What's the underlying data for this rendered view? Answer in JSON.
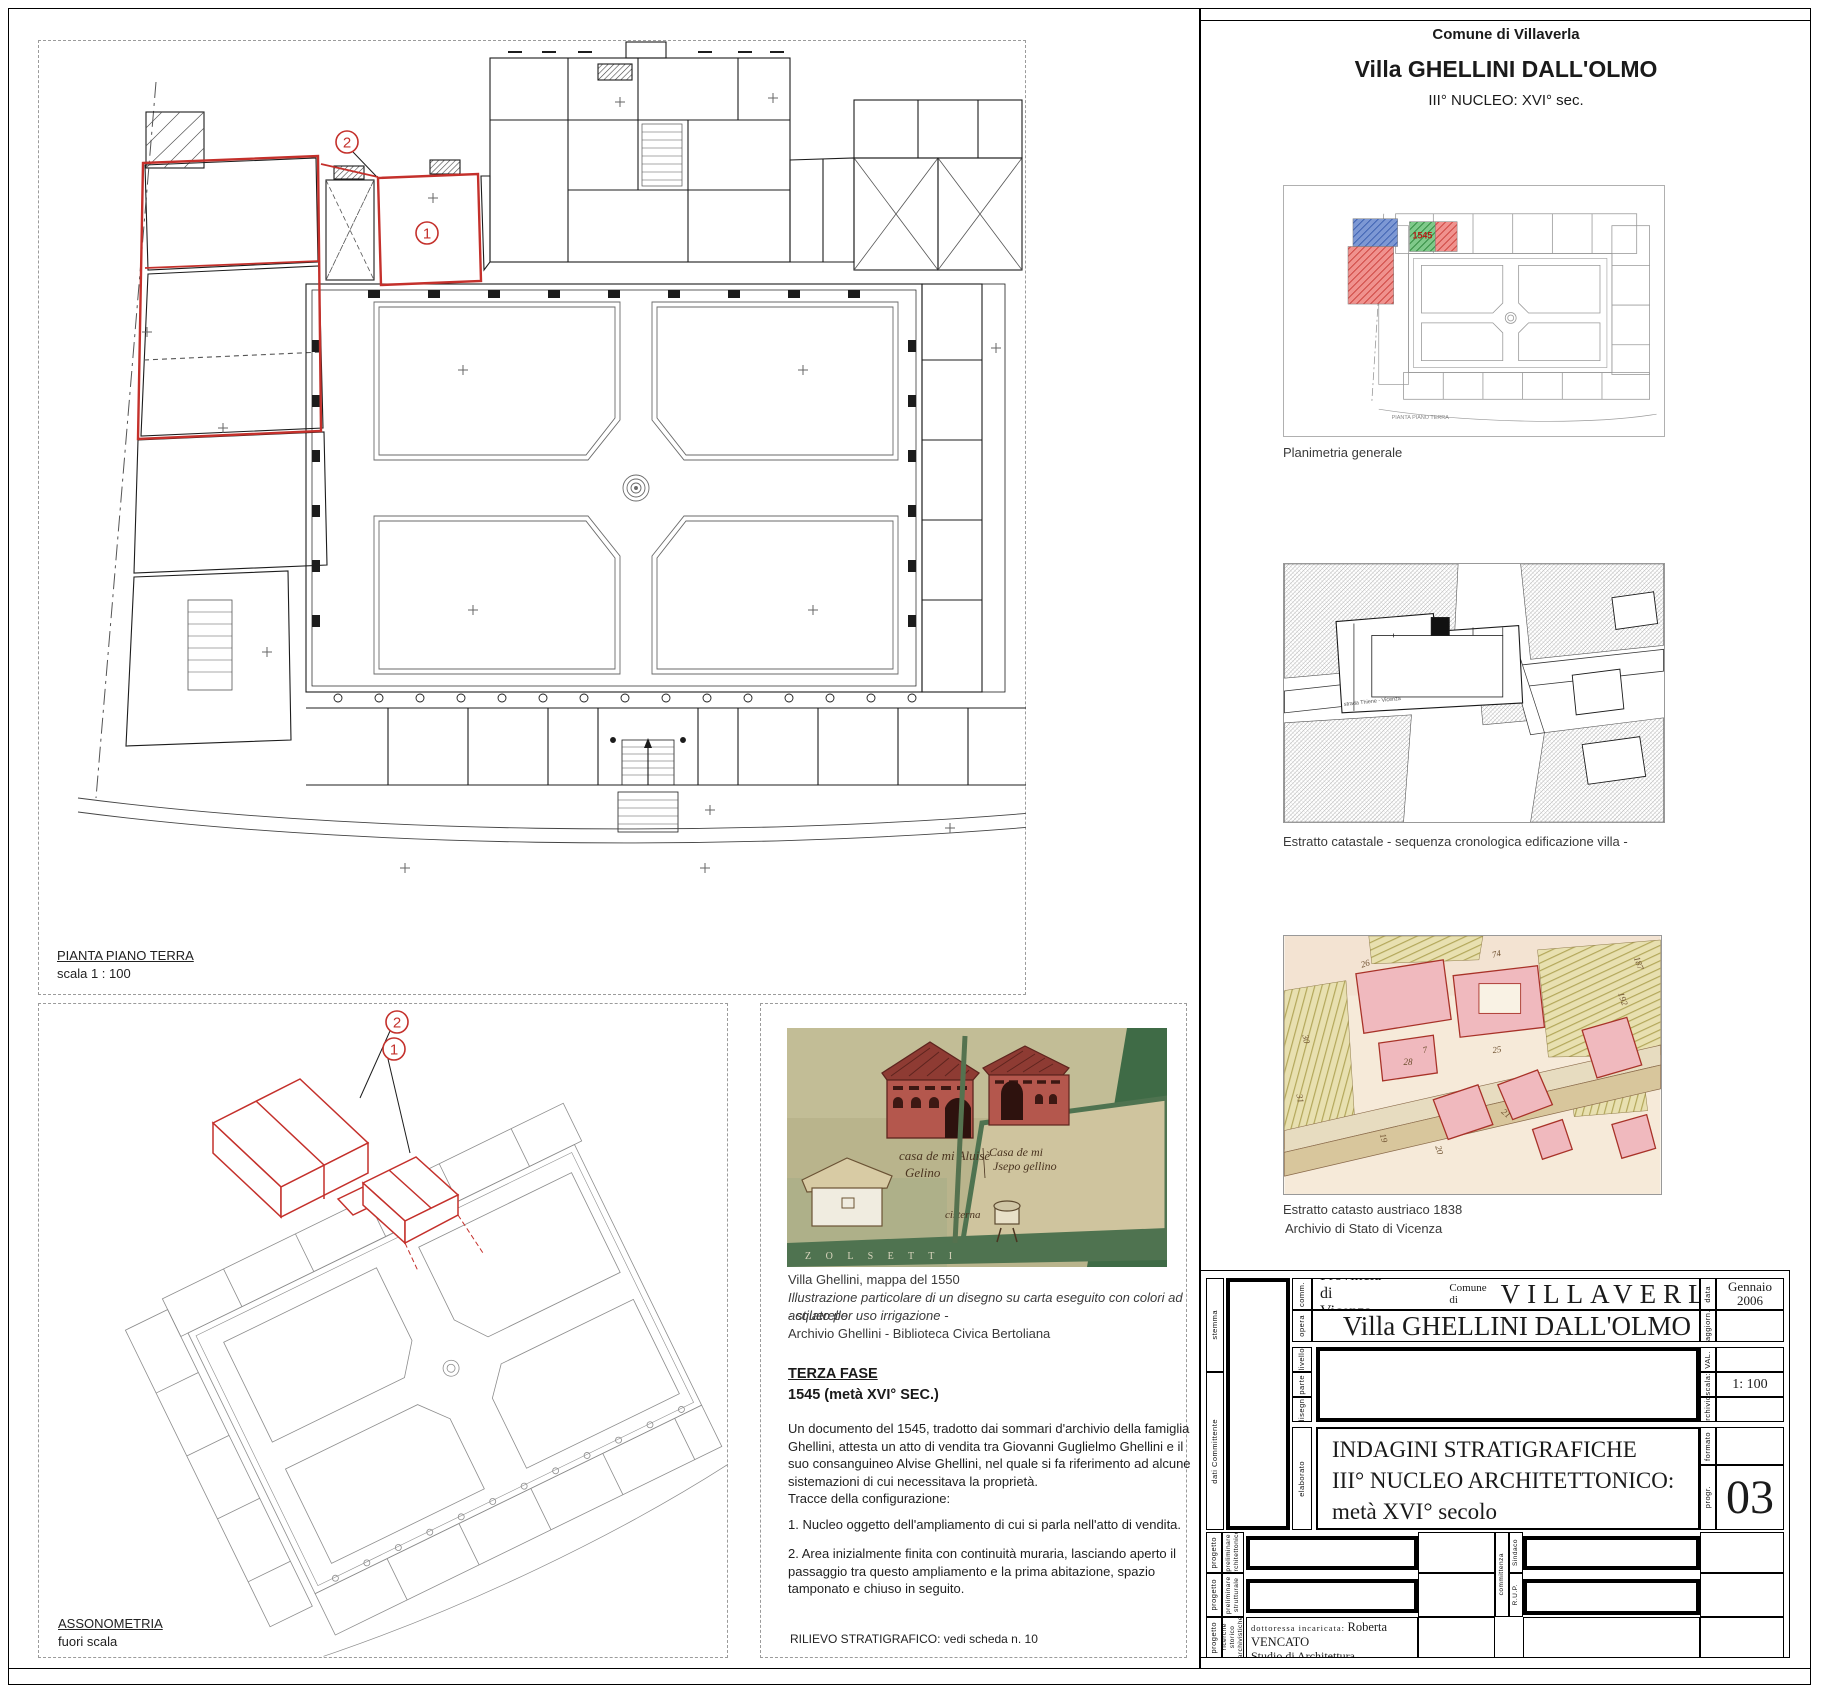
{
  "header": {
    "comune": "Comune di Villaverla",
    "title": "Villa GHELLINI  DALL'OLMO",
    "subtitle": "III° NUCLEO:  XVI° sec."
  },
  "main_plan": {
    "label": "PIANTA PIANO TERRA",
    "scale": "scala 1 : 100",
    "markers": [
      "1",
      "2"
    ]
  },
  "axonometry": {
    "label": "ASSONOMETRIA",
    "scale": "fuori scala",
    "markers": [
      "2",
      "1"
    ]
  },
  "watercolor": {
    "caption1": "Villa Ghellini, mappa del 1550",
    "caption2": "Illustrazione particolare di un disegno su carta eseguito con colori ad acquerello",
    "caption3": "- stilato per uso  irrigazione -",
    "caption4": "Archivio Ghellini - Biblioteca Civica Bertoliana",
    "insc_left1": "casa de mi Aluisè",
    "insc_left2": "Gelino",
    "insc_right1": "Casa de mi",
    "insc_right2": "Jsepo gellino",
    "insc_well": "cisterna",
    "band": "Z   O   L   S       E   T   T   I"
  },
  "terza": {
    "title": "TERZA  FASE",
    "subtitle": "1545 (metà  XVI° SEC.)",
    "paragraph": "Un documento del 1545, tradotto dai sommari d'archivio della famiglia Ghellini, attesta un atto di vendita tra Giovanni Guglielmo  Ghellini e il suo consanguineo Alvise Ghellini, nel quale si fa riferimento ad alcune sistemazioni di cui necessitava la proprietà.",
    "tracce": "Tracce della configurazione:",
    "item1": "1.  Nucleo oggetto dell'ampliamento di cui si parla nell'atto di vendita.",
    "item2": "2. Area inizialmente finita con continuità muraria, lasciando aperto il passaggio tra questo ampliamento e la prima abitazione, spazio tamponato e chiuso in seguito.",
    "footer": "RILIEVO STRATIGRAFICO: vedi scheda n. 10"
  },
  "right_column": {
    "planimetria": {
      "caption": "Planimetria generale",
      "year": "1545",
      "mini_label": "PIANTA PIANO TERRA"
    },
    "catastale": {
      "caption": "Estratto catastale  - sequenza cronologica edificazione villa -",
      "road": "strada Thiene - Vicenza"
    },
    "austriaco": {
      "caption1": "Estratto catasto austriaco 1838",
      "caption2": "Archivio di Stato di Vicenza",
      "parcels": [
        "26",
        "7",
        "28",
        "25",
        "74",
        "187",
        "192",
        "19",
        "20",
        "21",
        "31",
        "30"
      ]
    }
  },
  "tb": {
    "provincia": "Provincia di Vicenza",
    "comune_label": "Comune di",
    "comune": "VILLAVERLA",
    "opera": "Villa GHELLINI DALL'OLMO",
    "el1": "INDAGINI STRATIGRAFICHE",
    "el2": "III° NUCLEO ARCHITETTONICO:",
    "el3": "metà  XVI° secolo",
    "labels": {
      "stemma": "stemma",
      "comm": "comm.",
      "opera": "opera",
      "livello": "livello",
      "parte": "parte",
      "disegn": "disegn.",
      "dati": "dati  Committente",
      "elaborato": "elaborato",
      "data": "data",
      "aggiorn": "aggiorn.",
      "val": "VAL.",
      "scala": "scala:",
      "archivio": "archivio:",
      "formato": "formato",
      "progr": "progr.",
      "prog": "progetto",
      "prel_arch": "preliminare architettonico",
      "prel_strutt": "preliminare strutturale",
      "ric_stor": "ricerche storico archivistiche",
      "committenza": "committenza",
      "sindaco": "Sindaco",
      "rup": "R.U.P."
    },
    "values": {
      "data1": "Gennaio",
      "data2": "2006",
      "scala": "1: 100",
      "progr": "03"
    },
    "studio": {
      "lbl": "dottoressa incaricata:",
      "name": "Roberta VENCATO",
      "studio": "Studio di Architettura",
      "addr": "studio:  contrà delle Fontanelle, 17",
      "city": "36100 VICENZA (VI)",
      "tel": "tel 0444-511774-fax 0444-511774",
      "cf": "CF  VNC RRT 72D63 L551K"
    }
  },
  "colors": {
    "highlight_red": "#c4302b",
    "hatch_blue": "#4a6fbd",
    "hatch_green": "#2f9e44",
    "hatch_red": "#e0403a",
    "line_black": "#1c1c1c",
    "line_gray": "#8c8c8c"
  }
}
